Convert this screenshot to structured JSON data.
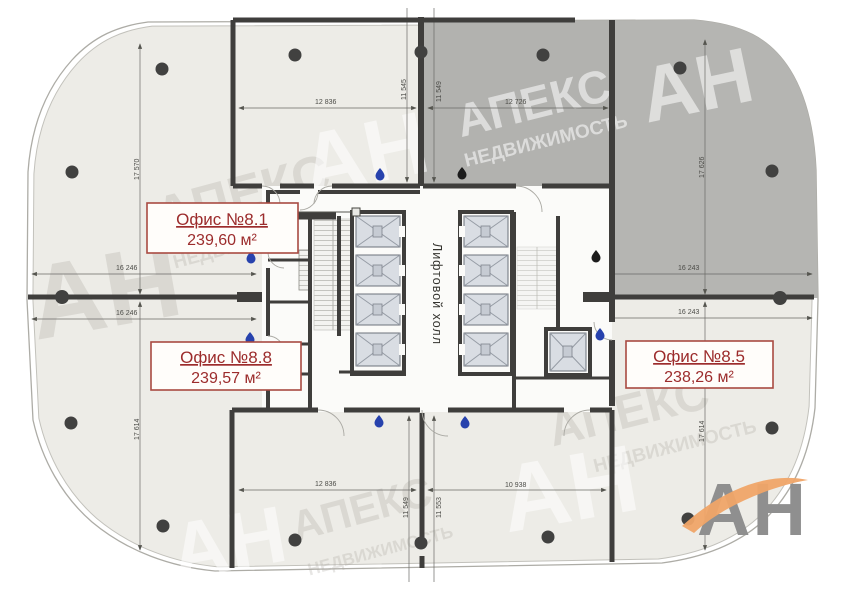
{
  "plan": {
    "offices": [
      {
        "name": "Офис №8.1",
        "area": "239,60 м²"
      },
      {
        "name": "Офис №8.8",
        "area": "239,57 м²"
      },
      {
        "name": "Офис №8.5",
        "area": "238,26 м²"
      }
    ],
    "core_label": "Лифтовой холл",
    "dimensions": {
      "top_left_v": "17 570",
      "top_room_w": "12 836",
      "top_room_h_left": "11 545",
      "top_room_h_right": "11 549",
      "dark_room_w": "12 726",
      "top_right_v": "17 626",
      "mid_left_upper": "16 246",
      "mid_left_lower": "16 246",
      "mid_right_upper": "16 243",
      "mid_right_lower": "16 243",
      "bottom_left_v": "17 614",
      "bottom_room_w": "12 836",
      "bottom_room_h_left": "11 549",
      "bottom_room_h_right": "11 553",
      "bottom_right_w": "10 938",
      "bottom_right_v": "17 614"
    }
  },
  "watermark": {
    "brand": "АПЕКС",
    "brand_sub": "НЕДВИЖИМОСТЬ",
    "abbr": "АН"
  },
  "logo": {
    "text": "АН"
  },
  "colors": {
    "floor": "#edece7",
    "sold_area": "#b5b5b2",
    "wall": "#3f3e3c",
    "label_red": "#9c2c2c",
    "drop_blue": "#2742ad",
    "logo_orange": "#f0a568",
    "logo_gray": "#8f8f8f"
  }
}
